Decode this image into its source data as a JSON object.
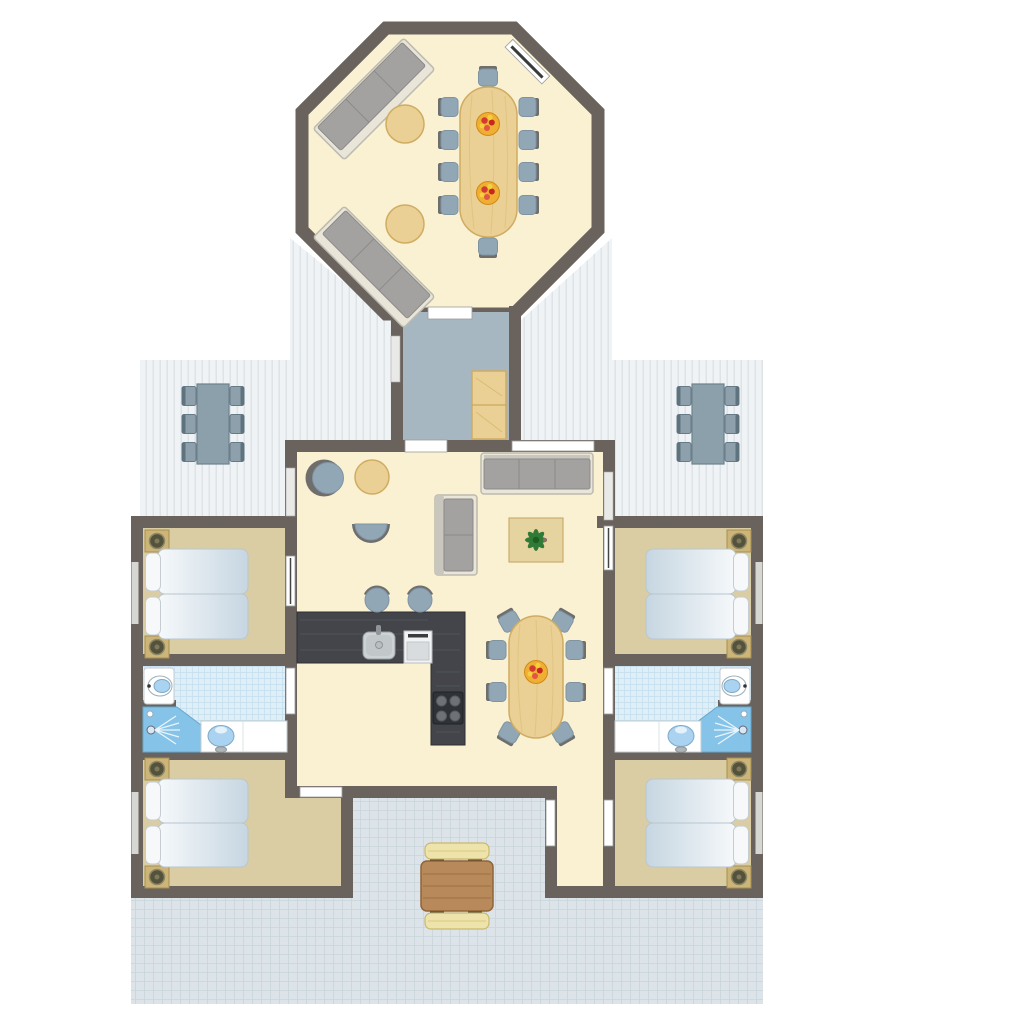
{
  "meta": {
    "description": "Top-down architectural floor plan of a holiday lodge: octagonal lounge-dining pavilion connected by a hallway to a main building with open-plan living room and kitchen, four bedrooms, two bathrooms, two covered plank decks and a tiled terrace with picnic table.",
    "view": "floor plan, no visible text labels"
  },
  "colors": {
    "wall": "#6A635D",
    "floor": "#FAF1D3",
    "bedroom_floor": "#DBCDA3",
    "hallway_floor": "#A6B7C1",
    "bathroom_tile": "#DFEFF8",
    "bathroom_tile_line": "#C3DEEE",
    "deck": "#F0F3F5",
    "deck_line": "#D9DFE2",
    "terrace": "#DCE3E9",
    "terrace_line": "#C9D4DC",
    "wood": "#EAD094",
    "wood_dark": "#D0AC62",
    "sofa_cushion": "#A3A2A0",
    "sofa_base": "#E9E5D8",
    "chair": "#92A7B6",
    "chair_back": "#6F6E6C",
    "bed": "#DDE7EE",
    "pillow": "#F7F8F9",
    "counter": "#43454A",
    "appliance": "#F2F3F4",
    "shower": "#85C3E8",
    "basin": "#A9D3F0",
    "picnic_table": "#B8895A",
    "bench": "#EFE3AC",
    "plant": "#2F7A36",
    "fruit_bowl": "#EFAF33",
    "fruit": "#D23B30",
    "door_mark": "#FFFFFF",
    "window_mark": "#E9E9E7"
  },
  "rooms": {
    "pavilion": {
      "name": "Octagonal lounge and dining pavilion",
      "floor": "cream",
      "furniture": [
        "two 3-seat sofas placed diagonally",
        "two round side tables",
        "10-seat oval dining table",
        "10 chairs",
        "2 fruit bowls",
        "window on upper-right wall",
        "door to hallway"
      ]
    },
    "hallway": {
      "name": "Connecting hallway",
      "floor": "blue-gray",
      "furniture": [
        "two-section wooden wardrobe",
        "window on left wall",
        "door to pavilion",
        "door to living room"
      ]
    },
    "living": {
      "name": "Living room with open kitchen",
      "floor": "cream",
      "furniture": [
        "teardrop lounge chair",
        "round side table",
        "half-moon chair",
        "two-seat sofa",
        "three-seat sofa",
        "coffee table with potted plant",
        "L-shaped dark kitchen counter",
        "sink",
        "oven",
        "4-burner cooktop",
        "2 bar stools",
        "6-8 seat oval dining table",
        "8 chairs",
        "fruit bowl"
      ]
    },
    "bedroom_left_top": {
      "name": "Bedroom upper left",
      "floor": "tan",
      "furniture": [
        "double bed (two mattresses)",
        "2 pillows",
        "2 bedside tables"
      ]
    },
    "bathroom_left": {
      "name": "Bathroom left",
      "floor": "light blue tiles",
      "furniture": [
        "toilet",
        "corner shower",
        "vanity with washbasin"
      ]
    },
    "bedroom_left_bottom": {
      "name": "Bedroom lower left",
      "floor": "tan",
      "furniture": [
        "double bed (two mattresses)",
        "2 pillows",
        "2 bedside tables"
      ]
    },
    "bedroom_right_top": {
      "name": "Bedroom upper right",
      "floor": "tan",
      "furniture": [
        "double bed (two mattresses)",
        "2 pillows",
        "2 bedside tables"
      ]
    },
    "bathroom_right": {
      "name": "Bathroom right",
      "floor": "light blue tiles",
      "furniture": [
        "toilet",
        "corner shower",
        "vanity with washbasin"
      ]
    },
    "bedroom_right_bottom": {
      "name": "Bedroom lower right",
      "floor": "tan",
      "furniture": [
        "double bed (two mattresses)",
        "2 pillows",
        "2 bedside tables"
      ]
    },
    "deck_left": {
      "name": "Covered deck left",
      "floor": "white planks",
      "furniture": [
        "rectangular outdoor table",
        "6 chairs"
      ]
    },
    "deck_right": {
      "name": "Covered deck right",
      "floor": "white planks",
      "furniture": [
        "rectangular outdoor table",
        "6 chairs"
      ]
    },
    "entrance": {
      "name": "Entrance passage",
      "floor": "cream",
      "furniture": [
        "door to terrace side",
        "door to lower right bedroom"
      ]
    },
    "terrace": {
      "name": "Tiled terrace",
      "floor": "small gray tiles",
      "furniture": [
        "square wooden picnic table",
        "2 benches"
      ]
    }
  }
}
